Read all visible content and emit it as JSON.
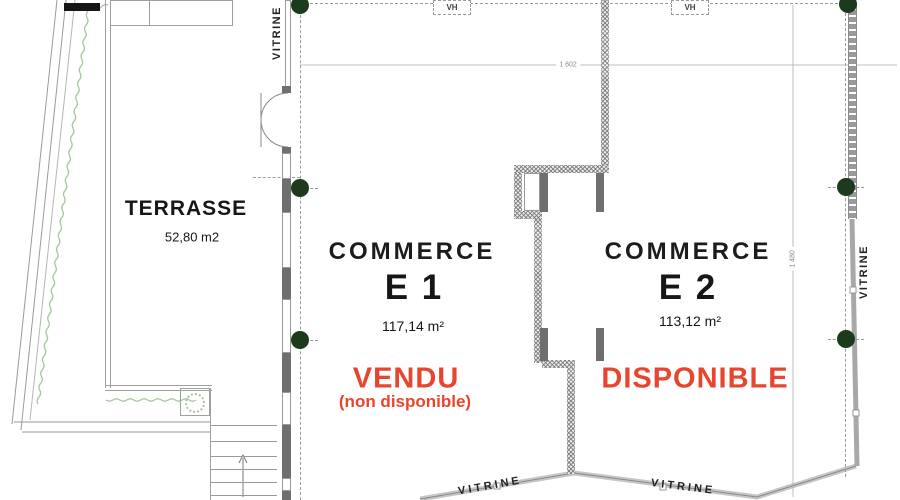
{
  "plan": {
    "terrasse": {
      "label": "TERRASSE",
      "area": "52,80 m2"
    },
    "e1": {
      "title": "COMMERCE",
      "unit": "E 1",
      "area": "117,14 m²",
      "status": "VENDU",
      "status_note": "(non disponible)"
    },
    "e2": {
      "title": "COMMERCE",
      "unit": "E 2",
      "area": "113,12 m²",
      "status": "DISPONIBLE"
    },
    "labels": {
      "vitrine": "VITRINE",
      "vh": "VH"
    },
    "dimensions": {
      "width": "1 602",
      "height": "1 480"
    },
    "colors": {
      "status_red": "#e8452f",
      "column_green": "#1c3a1c",
      "hedge_green": "#a6c79f",
      "wall_gray": "#6f6f6f",
      "line_gray": "#9a9a9a"
    }
  }
}
